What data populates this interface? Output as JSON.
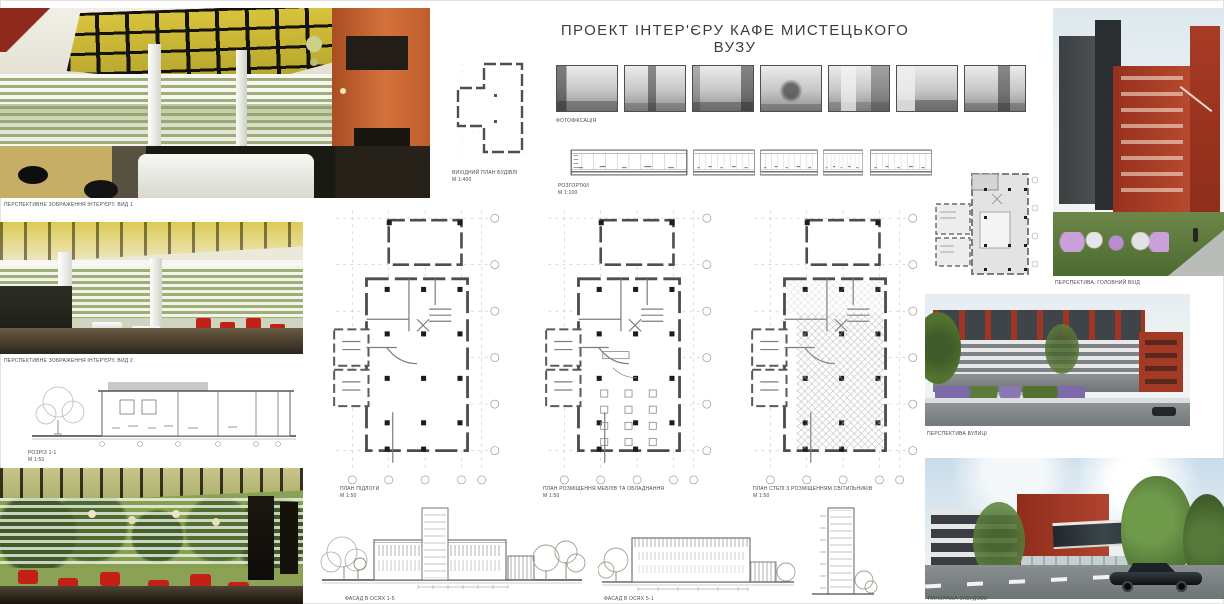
{
  "title": "ПРОЕКТ ІНТЕР'ЄРУ КАФЕ МИСТЕЦЬКОГО ВУЗУ",
  "left": {
    "render_top_caption": "ПЕРСПЕКТИВНЕ ЗОБРАЖЕННЯ ІНТЕР'ЄРУ. ВИД 1",
    "render_mid_caption": "ПЕРСПЕКТИВНЕ ЗОБРАЖЕННЯ ІНТЕР'ЄРУ. ВИД 2",
    "section": {
      "label": "РОЗРІЗ 1-1",
      "scale": "М 1:50"
    }
  },
  "center": {
    "site_plan": {
      "label": "ВИХІДНИЙ ПЛАН БУДІВЛІ",
      "scale": "М 1:400"
    },
    "photos": {
      "label": "ФОТОФІКСАЦІЯ",
      "count": 7
    },
    "unwraps": {
      "label": "РОЗГОРТКИ",
      "scale": "М 1:100"
    },
    "plans": [
      {
        "label": "ПЛАН ПІДЛОГИ",
        "scale": "М 1:50"
      },
      {
        "label": "ПЛАН РОЗМІЩЕННЯ МЕБЛІВ ТА ОБЛАДНАННЯ",
        "scale": "М 1:50"
      },
      {
        "label": "ПЛАН СТЕЛІ З РОЗМІЩЕННЯМ СВІТИЛЬНИКІВ",
        "scale": "М 1:50"
      }
    ],
    "facades": [
      {
        "label": "ФАСАД В ОСЯХ 1-5",
        "scale": "М 1:100"
      },
      {
        "label": "ФАСАД В ОСЯХ 5-1",
        "scale": "М 1:100"
      }
    ]
  },
  "right": {
    "explication": {
      "title": "ЕКСПЛІКАЦІЯ",
      "items": [
        "1. Вестибюль",
        "2. Гардероб",
        "3. Зал кафе",
        "4. Барна стійка",
        "5. Кухня",
        "6. Підсобні приміщення"
      ]
    },
    "render_top_caption": "ПЕРСПЕКТИВА. ГОЛОВНИЙ ВХІД",
    "render_mid_caption": "ПЕРСПЕКТИВА ВУЛИЦІ",
    "render_bottom_caption": "ПАНОРАМА ЗАБУДОВИ"
  },
  "palette": {
    "accent_orange": "#c2602f",
    "ceiling_yellow": "#d8c33b",
    "chair_red": "#c32018",
    "building_red": "#a33a26",
    "building_dark": "#3f4449",
    "foliage_green": "#5d8040",
    "sky_blue": "#d7e4ec"
  }
}
